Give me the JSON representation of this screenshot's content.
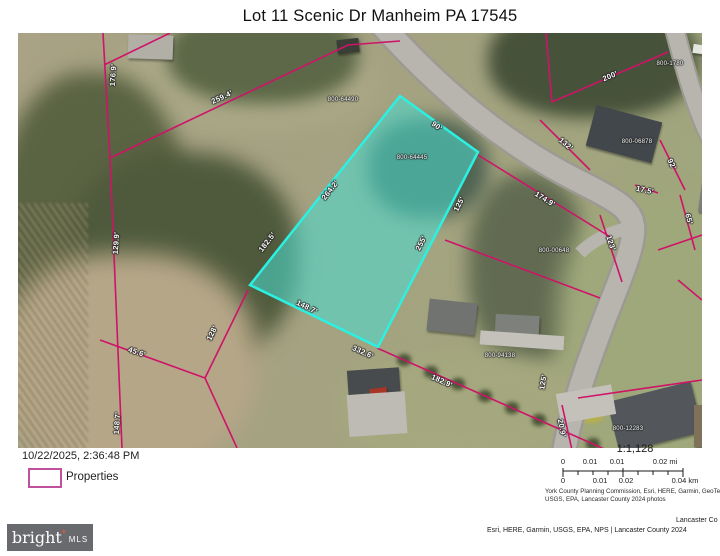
{
  "title": "Lot 11 Scenic Dr Manheim PA 17545",
  "legend": {
    "timestamp": "10/22/2025, 2:36:48 PM",
    "swatch_label": "Properties"
  },
  "scale": {
    "ratio": "1:1,128",
    "mi0": "0",
    "mi1": "0.01",
    "mi2": "0.01",
    "mi3": "0.02 mi",
    "km0": "0",
    "km1": "0.01",
    "km2": "0.02",
    "km3": "0.04 km",
    "attr1": "York County Planning Commission, Esri, HERE, Garmin, GeoTechnolog",
    "attr2": "USGS, EPA, Lancaster County 2024 photos"
  },
  "footer": {
    "logo_main": "bright",
    "logo_star": "✶",
    "logo_sub": "MLS",
    "credit1": "Lancaster Co",
    "credit2": "Esri, HERE, Garmin, USGS, EPA, NPS | Lancaster County 2024"
  },
  "colors": {
    "parcel_line": "#cf1368",
    "highlight_fill": "#48ded2",
    "highlight_stroke": "#2bf0e2",
    "legend_swatch_border": "#c0519c",
    "logo_bg": "#696a6d",
    "logo_star": "#e2593c"
  },
  "map": {
    "highlighted_parcel_id": "800-64445",
    "labels": [
      {
        "type": "dim",
        "text": "176.9'",
        "x": 95,
        "y": 42,
        "r": -86
      },
      {
        "type": "dim",
        "text": "259.4'",
        "x": 204,
        "y": 64,
        "r": -25
      },
      {
        "type": "dim",
        "text": "129.9'",
        "x": 98,
        "y": 210,
        "r": -86
      },
      {
        "type": "dim",
        "text": "182.5'",
        "x": 249,
        "y": 209,
        "r": -52
      },
      {
        "type": "dim",
        "text": "264.2'",
        "x": 312,
        "y": 157,
        "r": -52
      },
      {
        "type": "dim",
        "text": "90'",
        "x": 419,
        "y": 93,
        "r": 36
      },
      {
        "type": "dim",
        "text": "125'",
        "x": 441,
        "y": 171,
        "r": -63
      },
      {
        "type": "dim",
        "text": "255'",
        "x": 403,
        "y": 210,
        "r": -63
      },
      {
        "type": "dim",
        "text": "148.7'",
        "x": 289,
        "y": 274,
        "r": 26
      },
      {
        "type": "dim",
        "text": "45.6'",
        "x": 119,
        "y": 319,
        "r": 18
      },
      {
        "type": "dim",
        "text": "128'",
        "x": 194,
        "y": 300,
        "r": -64
      },
      {
        "type": "dim",
        "text": "148.7'",
        "x": 99,
        "y": 390,
        "r": -86
      },
      {
        "type": "dim",
        "text": "332.6'",
        "x": 345,
        "y": 319,
        "r": 24
      },
      {
        "type": "dim",
        "text": "182.9'",
        "x": 424,
        "y": 348,
        "r": 24
      },
      {
        "type": "dim",
        "text": "125'",
        "x": 525,
        "y": 349,
        "r": -80
      },
      {
        "type": "dim",
        "text": "20.9'",
        "x": 544,
        "y": 395,
        "r": 78
      },
      {
        "type": "dim",
        "text": "174.9'",
        "x": 527,
        "y": 166,
        "r": 32
      },
      {
        "type": "dim",
        "text": "123'",
        "x": 593,
        "y": 210,
        "r": 72
      },
      {
        "type": "dim",
        "text": "65'",
        "x": 671,
        "y": 186,
        "r": 75
      },
      {
        "type": "dim",
        "text": "17.5'",
        "x": 627,
        "y": 157,
        "r": 12
      },
      {
        "type": "dim",
        "text": "92'",
        "x": 654,
        "y": 131,
        "r": 63
      },
      {
        "type": "dim",
        "text": "132'",
        "x": 548,
        "y": 111,
        "r": 40
      },
      {
        "type": "dim",
        "text": "200'",
        "x": 592,
        "y": 43,
        "r": -23
      },
      {
        "type": "dim",
        "text": "100'",
        "x": 697,
        "y": 59,
        "r": -85
      },
      {
        "type": "pid",
        "text": "800-64490",
        "x": 325,
        "y": 67,
        "r": 0
      },
      {
        "type": "pid",
        "text": "800-64445",
        "x": 394,
        "y": 125,
        "r": 0
      },
      {
        "type": "pid",
        "text": "800-06878",
        "x": 619,
        "y": 109,
        "r": 0
      },
      {
        "type": "pid",
        "text": "800-1780",
        "x": 652,
        "y": 31,
        "r": 0
      },
      {
        "type": "pid",
        "text": "800-00648",
        "x": 536,
        "y": 218,
        "r": 0
      },
      {
        "type": "pid",
        "text": "800-94138",
        "x": 482,
        "y": 323,
        "r": 0
      },
      {
        "type": "pid",
        "text": "800-12283",
        "x": 610,
        "y": 396,
        "r": 0
      }
    ]
  }
}
